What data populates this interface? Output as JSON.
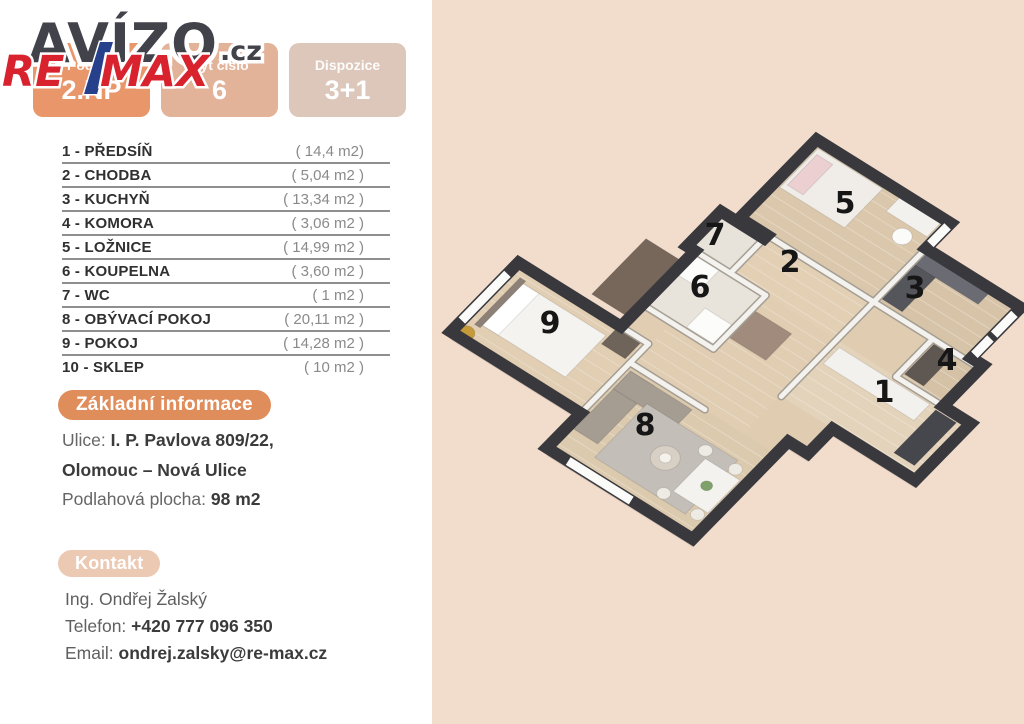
{
  "branding": {
    "watermark": "AVÍZO",
    "watermark_suffix": ".cz",
    "agency_re": "RE",
    "agency_max": "MAX"
  },
  "badges": [
    {
      "label": "Podlaží",
      "value": "2.NP"
    },
    {
      "label": "Byt číslo",
      "value": "6"
    },
    {
      "label": "Dispozice",
      "value": "3+1"
    }
  ],
  "rooms": [
    {
      "name": "1 - PŘEDSÍŇ",
      "area": "( 14,4 m2)"
    },
    {
      "name": "2 - CHODBA",
      "area": "( 5,04 m2 )"
    },
    {
      "name": "3 - KUCHYŇ",
      "area": "( 13,34 m2 )"
    },
    {
      "name": "4 - KOMORA",
      "area": "( 3,06 m2 )"
    },
    {
      "name": "5 - LOŽNICE",
      "area": "( 14,99 m2 )"
    },
    {
      "name": "6 - KOUPELNA",
      "area": "( 3,60 m2 )"
    },
    {
      "name": "7 - WC",
      "area": "( 1 m2 )"
    },
    {
      "name": "8 - OBÝVACÍ POKOJ",
      "area": "( 20,11 m2 )"
    },
    {
      "name": "9 - POKOJ",
      "area": "( 14,28 m2 )"
    },
    {
      "name": "10 - SKLEP",
      "area": "( 10 m2 )"
    }
  ],
  "info": {
    "badge": "Základní informace",
    "street_label": "Ulice:",
    "street_value": "I. P. Pavlova 809/22,",
    "street_value2": "Olomouc – Nová Ulice",
    "floor_area_label": "Podlahová plocha:",
    "floor_area_value": "98 m2"
  },
  "contact": {
    "badge": "Kontakt",
    "name": "Ing. Ondřej Žalský",
    "phone_label": "Telefon:",
    "phone": "+420 777 096 350",
    "email_label": "Email:",
    "email": "ondrej.zalsky@re-max.cz"
  },
  "colors": {
    "peach_bg": "#f2ddcd",
    "wall": "#39383d",
    "floor": "#dfccb1",
    "remax_red": "#d8232f",
    "remax_blue": "#26408c",
    "avizo_dark": "#42424a"
  },
  "floorplan": {
    "projection": {
      "ox": 440,
      "oy": 122,
      "ax": 0.788,
      "ay": 0.493,
      "bx": -0.616,
      "by": 0.63
    },
    "silhouette": [
      [
        310,
        -215
      ],
      [
        480,
        -215
      ],
      [
        480,
        -175
      ],
      [
        600,
        -175
      ],
      [
        600,
        -95
      ],
      [
        615,
        -95
      ],
      [
        615,
        -30
      ],
      [
        650,
        -30
      ],
      [
        650,
        60
      ],
      [
        545,
        60
      ],
      [
        545,
        100
      ],
      [
        520,
        100
      ],
      [
        520,
        255
      ],
      [
        335,
        255
      ],
      [
        335,
        200
      ],
      [
        170,
        200
      ],
      [
        170,
        90
      ],
      [
        300,
        90
      ],
      [
        300,
        -30
      ],
      [
        290,
        -30
      ],
      [
        290,
        -85
      ],
      [
        345,
        -85
      ],
      [
        345,
        -90
      ],
      [
        310,
        -90
      ]
    ],
    "room_floors": [
      {
        "u": 310,
        "v": -215,
        "w": 170,
        "h": 125,
        "fill": "#dbc8ac",
        "plank": true
      },
      {
        "u": 480,
        "v": -175,
        "w": 120,
        "h": 85,
        "fill": "#d7c4a8",
        "plank": true
      },
      {
        "u": 555,
        "v": -90,
        "w": 60,
        "h": 60,
        "fill": "#d4c1a6",
        "plank": true
      },
      {
        "u": 345,
        "v": -90,
        "w": 135,
        "h": 60,
        "fill": "#e2cfb4",
        "plank": true
      },
      {
        "u": 290,
        "v": -85,
        "w": 55,
        "h": 55,
        "fill": "#e7e3db",
        "plank": false
      },
      {
        "u": 300,
        "v": -30,
        "w": 90,
        "h": 85,
        "fill": "#e8e4dc",
        "plank": false
      },
      {
        "u": 390,
        "v": -30,
        "w": 90,
        "h": 85,
        "fill": "#e0cdb2",
        "plank": true
      },
      {
        "u": 300,
        "v": 55,
        "w": 40,
        "h": 35,
        "fill": "#e0cdb2",
        "plank": false
      },
      {
        "u": 335,
        "v": 55,
        "w": 145,
        "h": 65,
        "fill": "#e0cdb2",
        "plank": true
      },
      {
        "u": 480,
        "v": -30,
        "w": 170,
        "h": 90,
        "fill": "#e4d3bb",
        "plank": true
      },
      {
        "u": 170,
        "v": 90,
        "w": 165,
        "h": 110,
        "fill": "#e1ceb3",
        "plank": true
      },
      {
        "u": 335,
        "v": 120,
        "w": 185,
        "h": 135,
        "fill": "#dccaae",
        "plank": true
      }
    ],
    "walls": [
      [
        310,
        -90,
        615,
        -90
      ],
      [
        480,
        -175,
        480,
        -90
      ],
      [
        480,
        -90,
        480,
        60
      ],
      [
        555,
        -90,
        555,
        -30
      ],
      [
        555,
        -30,
        615,
        -30
      ],
      [
        345,
        -85,
        345,
        -30
      ],
      [
        290,
        -30,
        390,
        -30
      ],
      [
        390,
        -30,
        390,
        55
      ],
      [
        300,
        55,
        390,
        55
      ],
      [
        300,
        90,
        335,
        90
      ],
      [
        335,
        90,
        335,
        200
      ],
      [
        335,
        120,
        430,
        120
      ]
    ],
    "windows": [
      [
        480,
        -210,
        480,
        -182
      ],
      [
        600,
        -165,
        600,
        -132
      ],
      [
        600,
        -126,
        600,
        -100
      ],
      [
        170,
        108,
        170,
        182
      ],
      [
        362,
        255,
        442,
        255
      ]
    ],
    "furniture": [
      {
        "type": "rect",
        "u": 190,
        "v": 108,
        "w": 105,
        "h": 66,
        "fill": "#f5f3ef"
      },
      {
        "type": "rect",
        "u": 190,
        "v": 108,
        "w": 20,
        "h": 66,
        "fill": "#ffffff"
      },
      {
        "type": "rect",
        "u": 183,
        "v": 104,
        "w": 7,
        "h": 74,
        "fill": "#8d8177"
      },
      {
        "type": "rect",
        "u": 298,
        "v": 93,
        "w": 30,
        "h": 26,
        "fill": "#6e6459"
      },
      {
        "type": "circle",
        "u": 183,
        "v": 192,
        "r": 9,
        "fill": "#c49a3a"
      },
      {
        "type": "rect",
        "u": 318,
        "v": -207,
        "w": 82,
        "h": 62,
        "fill": "#f0ede8"
      },
      {
        "type": "rect",
        "u": 322,
        "v": -200,
        "w": 20,
        "h": 48,
        "fill": "#eccfd1"
      },
      {
        "type": "rect",
        "u": 420,
        "v": -213,
        "w": 52,
        "h": 26,
        "fill": "#f3f1ed"
      },
      {
        "type": "circle",
        "u": 452,
        "v": -172,
        "r": 10,
        "fill": "#fbfbfa"
      },
      {
        "type": "rect",
        "u": 484,
        "v": -170,
        "w": 26,
        "h": 72,
        "fill": "#55555c"
      },
      {
        "type": "rect",
        "u": 484,
        "v": -172,
        "w": 80,
        "h": 20,
        "fill": "#6b6b74"
      },
      {
        "type": "rect",
        "u": 560,
        "v": -86,
        "w": 24,
        "h": 48,
        "fill": "#5f5751"
      },
      {
        "type": "rect",
        "u": 488,
        "v": -24,
        "w": 115,
        "h": 26,
        "fill": "#f3f1ee"
      },
      {
        "type": "rect",
        "u": 612,
        "v": -22,
        "w": 26,
        "h": 68,
        "fill": "#46464d"
      },
      {
        "type": "rect",
        "u": 304,
        "v": -26,
        "w": 30,
        "h": 30,
        "fill": "#fcfcfb"
      },
      {
        "type": "rect",
        "u": 352,
        "v": 20,
        "w": 34,
        "h": 30,
        "fill": "#fcfcfb"
      },
      {
        "type": "rect",
        "u": 252,
        "v": -12,
        "w": 44,
        "h": 88,
        "fill": "#77675a"
      },
      {
        "type": "rect",
        "u": 392,
        "v": -8,
        "w": 48,
        "h": 42,
        "fill": "#a18b7c"
      },
      {
        "type": "rect",
        "u": 342,
        "v": 128,
        "w": 30,
        "h": 92,
        "fill": "#a59c92"
      },
      {
        "type": "rect",
        "u": 342,
        "v": 128,
        "w": 78,
        "h": 28,
        "fill": "#a59c92"
      },
      {
        "type": "rect",
        "u": 380,
        "v": 150,
        "w": 115,
        "h": 85,
        "fill": "#c3beb8"
      },
      {
        "type": "circle",
        "u": 436,
        "v": 192,
        "r": 15,
        "fill": "#d8d0c5"
      },
      {
        "type": "circle",
        "u": 436,
        "v": 192,
        "r": 6,
        "fill": "#f5f2ec"
      },
      {
        "type": "rect",
        "u": 468,
        "v": 168,
        "w": 44,
        "h": 52,
        "fill": "#f4f2ee"
      },
      {
        "type": "circle",
        "u": 462,
        "v": 160,
        "r": 7,
        "fill": "#eeebe5"
      },
      {
        "type": "circle",
        "u": 500,
        "v": 160,
        "r": 7,
        "fill": "#eeebe5"
      },
      {
        "type": "circle",
        "u": 462,
        "v": 228,
        "r": 7,
        "fill": "#eeebe5"
      },
      {
        "type": "circle",
        "u": 505,
        "v": 228,
        "r": 7,
        "fill": "#eeebe5"
      },
      {
        "type": "circle",
        "u": 490,
        "v": 194,
        "r": 6,
        "fill": "#7fa26b"
      }
    ],
    "labels": [
      {
        "n": "1",
        "x": 884,
        "y": 402
      },
      {
        "n": "2",
        "x": 790,
        "y": 272
      },
      {
        "n": "3",
        "x": 915,
        "y": 298
      },
      {
        "n": "4",
        "x": 947,
        "y": 370
      },
      {
        "n": "5",
        "x": 845,
        "y": 213
      },
      {
        "n": "6",
        "x": 700,
        "y": 297
      },
      {
        "n": "7",
        "x": 715,
        "y": 245
      },
      {
        "n": "8",
        "x": 645,
        "y": 435
      },
      {
        "n": "9",
        "x": 550,
        "y": 333
      }
    ]
  }
}
